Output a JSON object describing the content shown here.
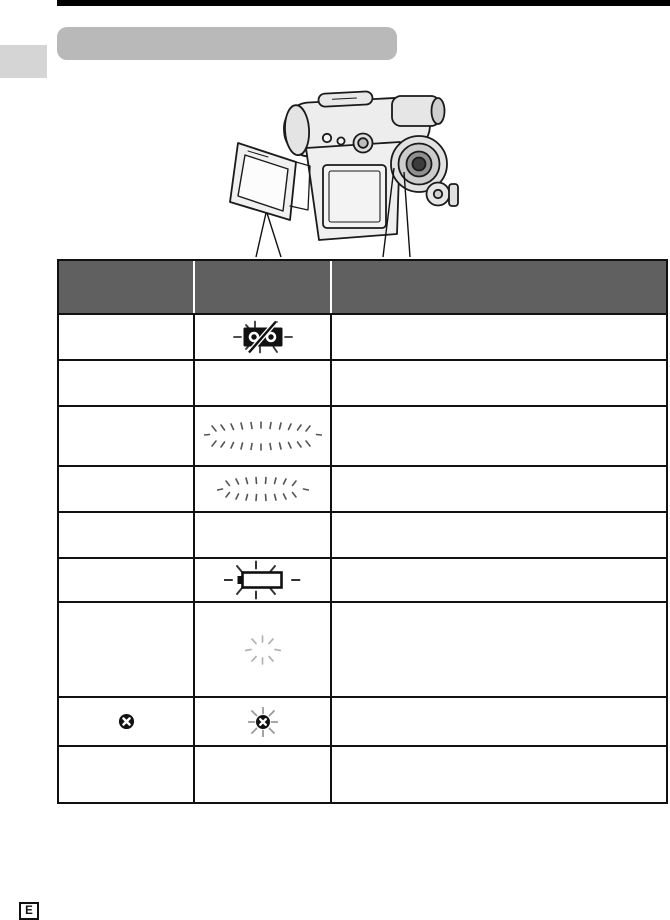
{
  "header": {
    "title": ""
  },
  "illustration": {
    "name": "camcorder-with-open-lcd",
    "callouts": [
      "lcd-screen-pointer",
      "viewfinder-pointer"
    ]
  },
  "table": {
    "header_columns": [
      {
        "id": "col-1",
        "label": ""
      },
      {
        "id": "col-2",
        "label": ""
      },
      {
        "id": "col-3",
        "label": ""
      }
    ],
    "rows": [
      {
        "cells": [
          {
            "icon": null
          },
          {
            "icon": "cassette-slash-flashing"
          },
          {
            "icon": null
          }
        ]
      },
      {
        "cells": [
          {
            "icon": null
          },
          {
            "icon": null
          },
          {
            "icon": null
          }
        ]
      },
      {
        "cells": [
          {
            "icon": null
          },
          {
            "icon": "flash-burst-wide"
          },
          {
            "icon": null
          }
        ]
      },
      {
        "cells": [
          {
            "icon": null
          },
          {
            "icon": "flash-burst-medium"
          },
          {
            "icon": null
          }
        ]
      },
      {
        "cells": [
          {
            "icon": null
          },
          {
            "icon": null
          },
          {
            "icon": null
          }
        ]
      },
      {
        "cells": [
          {
            "icon": null
          },
          {
            "icon": "battery-empty-flashing"
          },
          {
            "icon": null
          }
        ]
      },
      {
        "cells": [
          {
            "icon": null
          },
          {
            "icon": "flash-burst-small"
          },
          {
            "icon": null
          }
        ]
      },
      {
        "cells": [
          {
            "icon": "record-inhibit"
          },
          {
            "icon": "record-inhibit-flashing"
          },
          {
            "icon": null
          }
        ]
      },
      {
        "cells": [
          {
            "icon": null
          },
          {
            "icon": null
          },
          {
            "icon": null
          }
        ]
      }
    ]
  },
  "footer": {
    "edition_marker": "E"
  },
  "colors": {
    "top_rule": "#000000",
    "title_bar_bg": "#b9b9b9",
    "side_tab_bg": "#d5d5d5",
    "table_header_bg": "#606060",
    "table_border": "#111111"
  }
}
